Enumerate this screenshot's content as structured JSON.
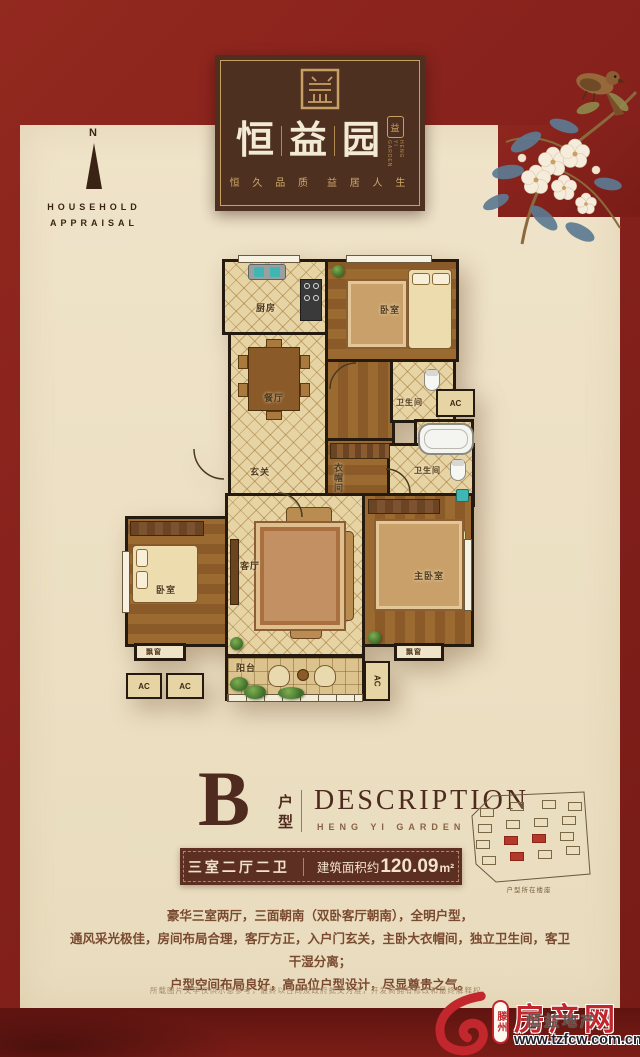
{
  "brand": {
    "title_chars": [
      "恒",
      "益",
      "园"
    ],
    "mini_seal_char": "益",
    "mini_seal_caption": "HENG YI GARDEN",
    "tagline_left": "恒 久 品 质",
    "tagline_right": "益 居 人 生"
  },
  "compass": {
    "n": "N",
    "line1": "HOUSEHOLD",
    "line2": "APPRAISAL"
  },
  "plan": {
    "rooms": {
      "kitchen": "厨房",
      "bedroom": "卧室",
      "dining": "餐厅",
      "entry": "玄关",
      "cloakroom": "衣帽间",
      "bathroom": "卫生间",
      "living": "客厅",
      "master": "主卧室",
      "balcony": "阳台",
      "bay_window": "飘窗",
      "ac": "AC"
    }
  },
  "section": {
    "type_letter": "B",
    "type_label": "户型",
    "heading": "DESCRIPTION",
    "subheading": "HENG YI GARDEN",
    "spec_rooms": "三室二厅二卫",
    "area_prefix": "建筑面积约",
    "area_value": "120.09",
    "area_unit": "m²",
    "description_lines": [
      "豪华三室两厅，三面朝南（双卧客厅朝南），全明户型，",
      "通风采光极佳，房间布局合理，客厅方正，入户门玄关，主卧大衣帽间，独立卫生间，客卫干湿分离；",
      "户型空间布局良好，高品位户型设计，尽显尊贵之气。"
    ],
    "disclaimer": "所载图片文字仅供示意参考，最终以合同及政府批文为准，开发商拥有修改和最终解释权。",
    "sitemap_caption": "户型所在楼座"
  },
  "watermark": {
    "city": "滕州",
    "name": "房产网",
    "overlay": "恒益地产",
    "url": "www.tzfcw.com.cn"
  },
  "colors": {
    "red": "#8c231d",
    "dark_red": "#6d1713",
    "cream": "#ece0c4",
    "gold": "#c9a063",
    "logo_brown": "#4e3020",
    "ink_brown": "#4f2a1e",
    "bar_brown": "#5d2f23",
    "watermark_red": "#c1272d"
  }
}
